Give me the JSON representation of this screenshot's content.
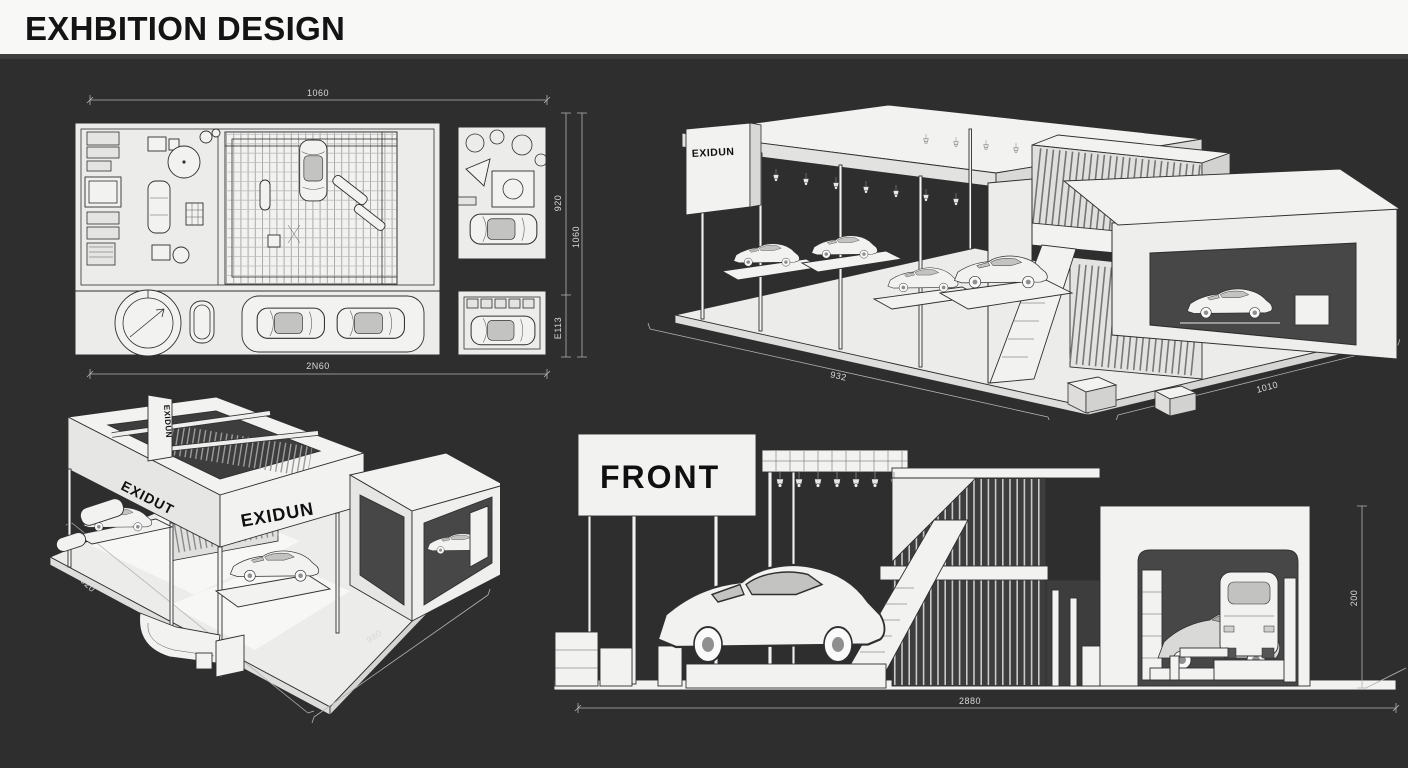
{
  "header": {
    "title": "EXHBITION DESIGN"
  },
  "colors": {
    "background": "#2e2e2e",
    "header_background": "#f8f8f7",
    "drawing_fill": "#ececeb",
    "drawing_line": "#2f2f2f",
    "interior_dark": "#474747",
    "dimension_line": "#b2b2b2",
    "dimension_text": "#d8d8d8",
    "title_text": "#141414"
  },
  "views": {
    "floor_plan": {
      "name": "booth floor plan (top view)",
      "dims": {
        "top": "1060",
        "bottom": "2N60",
        "right_inner_top": "920",
        "right_inner_bottom": "E113",
        "right_outer": "1060"
      }
    },
    "perspective_main": {
      "name": "isometric booth view (top right)",
      "sign": "EXIDUN",
      "dims": {
        "left": "932",
        "right": "1010"
      }
    },
    "perspective_alt": {
      "name": "isometric booth view (bottom left)",
      "sign_side": "EXIDUT",
      "sign_front": "EXIDUN",
      "sign_post": "EXIDUN",
      "dims": {
        "left": "920",
        "bottom": "980"
      }
    },
    "front_elevation": {
      "name": "front elevation",
      "label": "FRONT",
      "dims": {
        "bottom": "2880",
        "right": "200"
      }
    }
  }
}
